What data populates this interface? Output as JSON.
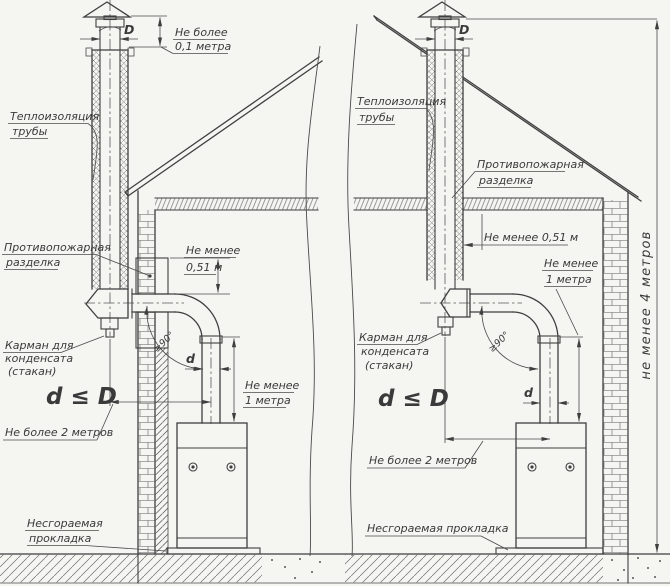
{
  "meta": {
    "description_domain": "technical installation drawing, two chimney schemes",
    "paper_color": "#f5f5f2",
    "ink_color": "#3f3f3f"
  },
  "left": {
    "dim_d": "D",
    "cap_height_1": "Не более",
    "cap_height_2": "0,1 метра",
    "insulation_1": "Теплоизоляция",
    "insulation_2": "трубы",
    "firecut_1": "Противопожарная",
    "firecut_2": "разделка",
    "min051_1": "Не менее",
    "min051_2": "0,51 м",
    "condensate_1": "Карман для",
    "condensate_2": "конденсата",
    "condensate_3": "(стакан)",
    "formula": "d ≤ D",
    "max2m": "Не более 2 метров",
    "min1m_1": "Не менее",
    "min1m_2": "1 метра",
    "angle": "≥90°",
    "d_small": "d",
    "pad_1": "Несгораемая",
    "pad_2": "прокладка"
  },
  "right": {
    "dim_d": "D",
    "insulation_1": "Теплоизоляция",
    "insulation_2": "трубы",
    "firecut_1": "Противопожарная",
    "firecut_2": "разделка",
    "min051": "Не менее 0,51 м",
    "min1m_1": "Не менее",
    "min1m_2": "1 метра",
    "condensate_1": "Карман для",
    "condensate_2": "конденсата",
    "condensate_3": "(стакан)",
    "formula": "d ≤ D",
    "max2m": "Не более 2 метров",
    "angle": "≥90°",
    "d_small": "d",
    "pad": "Несгораемая прокладка",
    "height4m": "не менее 4 метров"
  }
}
